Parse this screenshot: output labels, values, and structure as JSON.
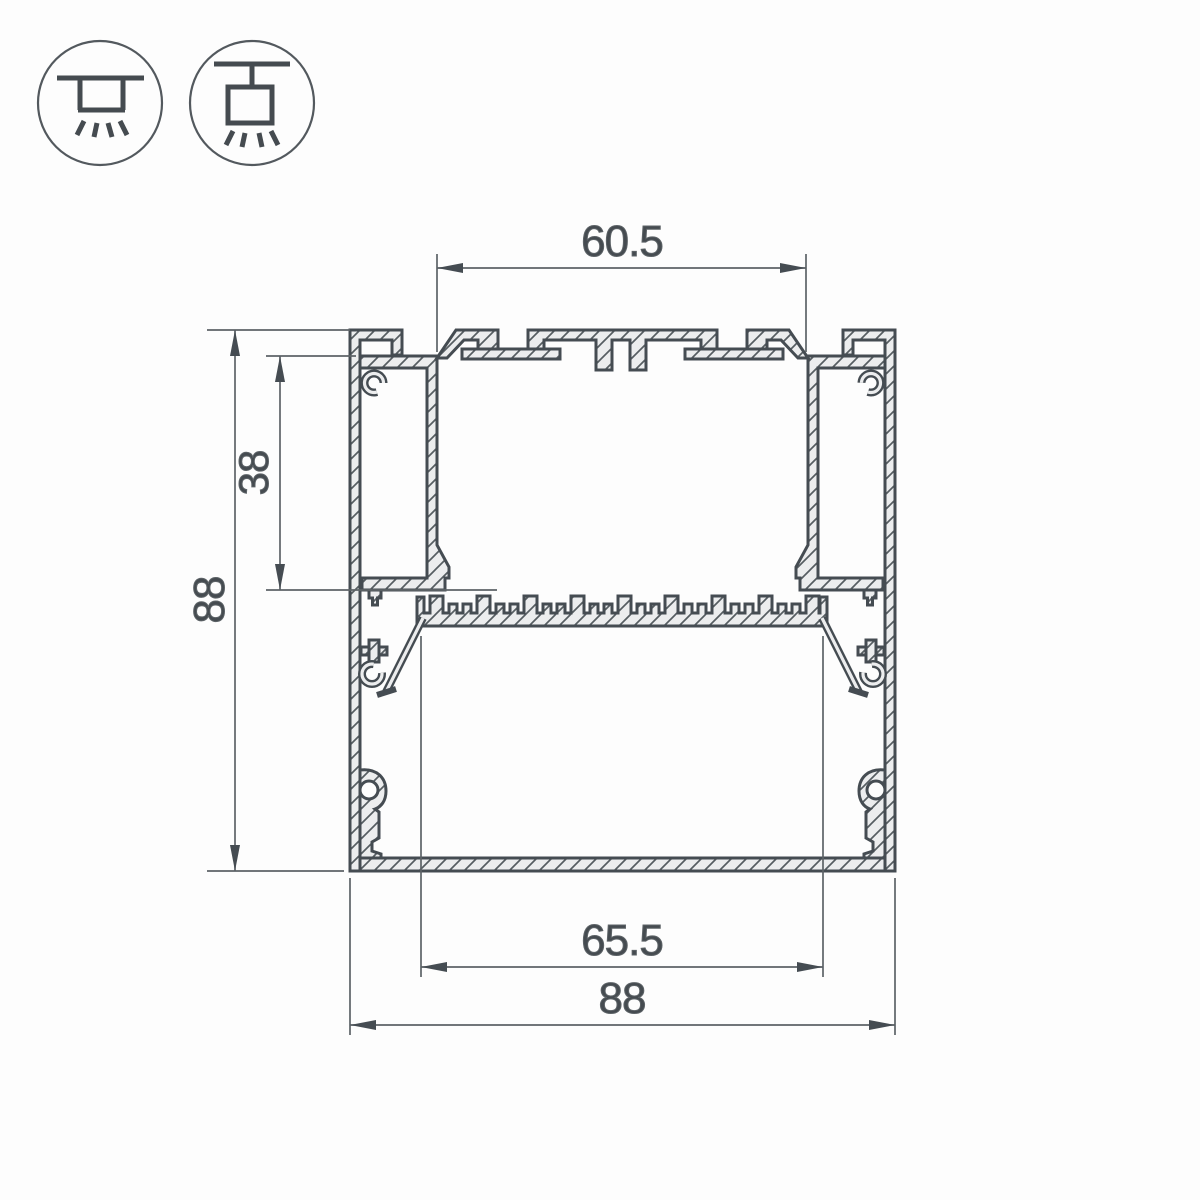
{
  "drawing": {
    "title": "aluminium-led-profile-cross-section",
    "dim_top_width": "60.5",
    "dim_channel_depth": "38",
    "dim_overall_height": "88",
    "dim_inner_width": "65.5",
    "dim_overall_width": "88"
  },
  "icons": {
    "surface_mount": "surface-ceiling-mount-light",
    "pendant_mount": "suspended-pendant-light"
  },
  "colors": {
    "outline": "#454c52",
    "dimension": "#5d6367",
    "text": "#454b50",
    "metal_fill": "#ecedee",
    "hatch": "#565d62",
    "background": "#fdfdfd"
  }
}
